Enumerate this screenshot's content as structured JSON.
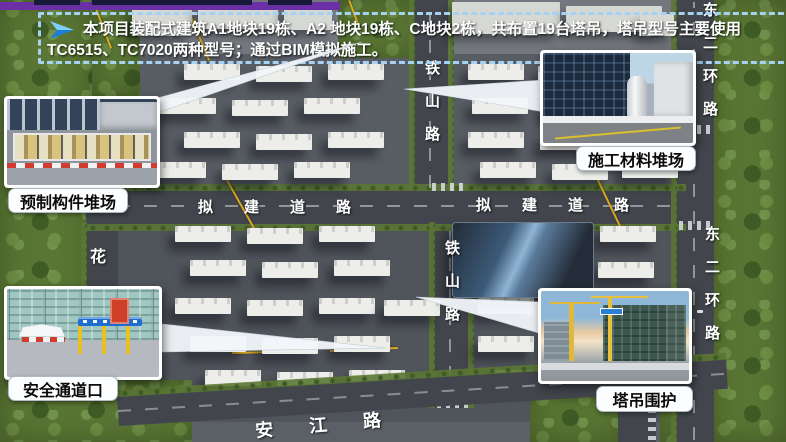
{
  "header": {
    "icon": "arrow-pointer-icon",
    "line1": "本项目装配式建筑A1地块19栋、A2 地块19栋、C地块2栋，共布置19台塔吊，塔吊型号主要使用",
    "line2": "TC6515、TC7020两种型号；通过BIM模拟施工。"
  },
  "callouts": {
    "prefab": {
      "label": "预制构件堆场",
      "image": "prefab-component-yard-photo"
    },
    "materials": {
      "label": "施工材料堆场",
      "image": "construction-material-yard-photo"
    },
    "safety": {
      "label": "安全通道口",
      "image": "safety-passage-entrance-photo"
    },
    "crane": {
      "label": "塔吊围护",
      "image": "tower-crane-enclosure-photo"
    }
  },
  "map": {
    "roads": {
      "tieshan_upper": "铁山路",
      "tieshan_lower": "铁山路",
      "proposed_left": "拟建道路",
      "proposed_right": "拟建道路",
      "east_ring_upper": "东二环路",
      "east_ring_lower": "东二环路",
      "hua": "花",
      "anjiang": "安江路"
    }
  },
  "colors": {
    "accent_purple": "#6b2fa6",
    "dashed_border_blue": "#a5d2f2",
    "crane_line_yellow": "#d8a81e",
    "header_text": "#ffffff"
  }
}
